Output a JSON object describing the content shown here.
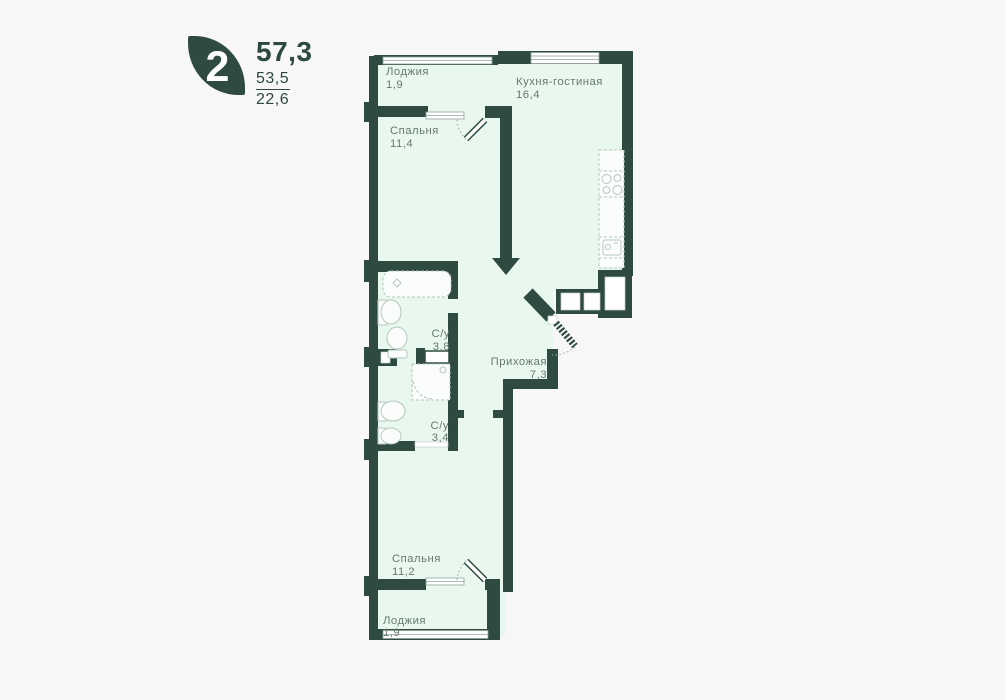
{
  "unit_card": {
    "rooms_count": "2",
    "total_area": "57,3",
    "area_alt_top": "53,5",
    "area_alt_bottom": "22,6"
  },
  "rooms": {
    "loggia_top": {
      "name": "Лоджия",
      "area": "1,9"
    },
    "kitchen_living": {
      "name": "Кухня-гостиная",
      "area": "16,4"
    },
    "bedroom_top": {
      "name": "Спальня",
      "area": "11,4"
    },
    "bathroom_top": {
      "name": "С/у",
      "area": "3,8"
    },
    "hallway": {
      "name": "Прихожая",
      "area": "7,3"
    },
    "bathroom_bottom": {
      "name": "С/у",
      "area": "3,4"
    },
    "bedroom_bottom": {
      "name": "Спальня",
      "area": "11,2"
    },
    "loggia_bottom": {
      "name": "Лоджия",
      "area": "1,9"
    }
  },
  "colors": {
    "wall": "#2e4a41",
    "floor": "#e9f8ef",
    "background": "#f7f7f7",
    "label": "#66796f"
  }
}
